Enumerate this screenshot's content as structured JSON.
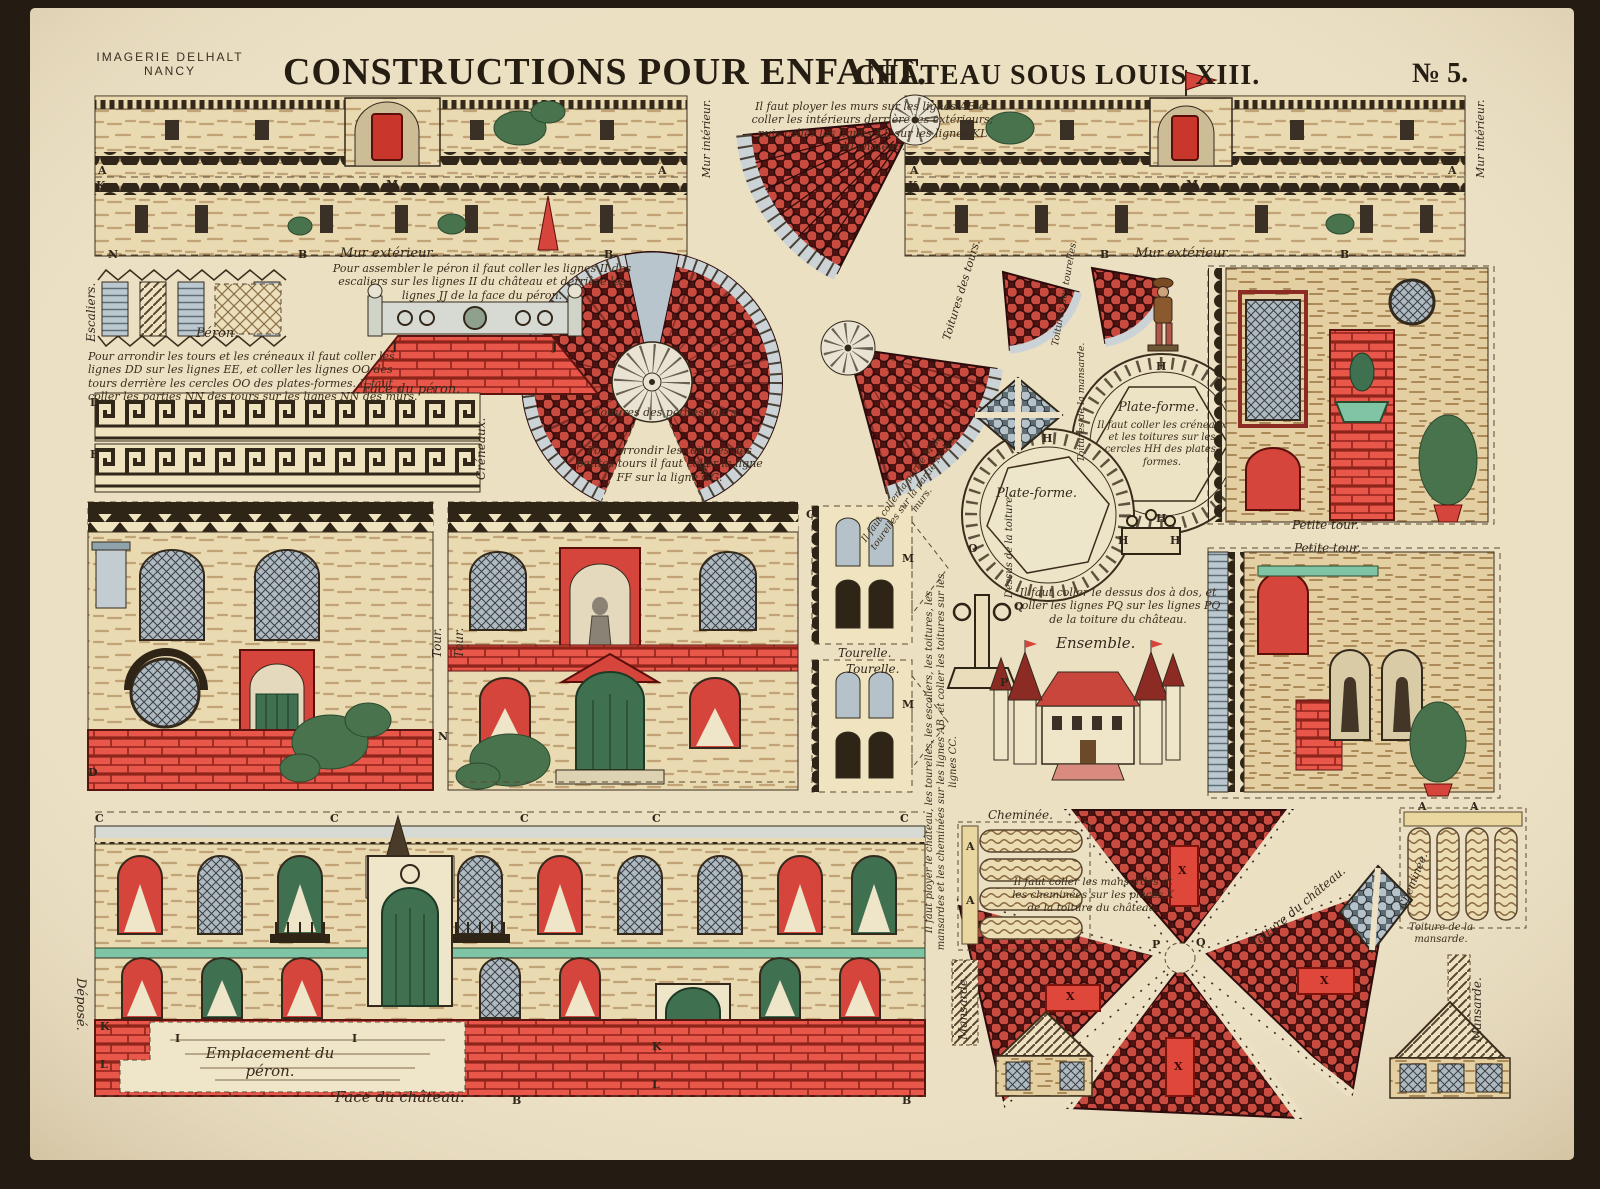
{
  "header": {
    "imprint_line1": "IMAGERIE DELHALT",
    "imprint_line2": "NANCY",
    "title": "CONSTRUCTIONS POUR ENFANT.",
    "subtitle": "CHÂTEAU SOUS LOUIS XIII.",
    "plate_number": "№ 5."
  },
  "labels": {
    "mur_exterieur_left": "Mur extérieur.",
    "mur_exterieur_right": "Mur extérieur.",
    "mur_interieur_left": "Mur intérieur.",
    "mur_interieur_right": "Mur intérieur.",
    "toitures_des_tours": "Toitures des tours.",
    "toitures_des_tourelles": "Toitures des tourelles.",
    "toitures_petites_tours": "Toitures des petites tours.",
    "escaliers": "Escaliers.",
    "peron": "Péron.",
    "face_du_peron": "Face du péron.",
    "creneaux": "Créneaux.",
    "tour_a": "Tour.",
    "tour_b": "Tour.",
    "tourelle_a": "Tourelle.",
    "tourelle_b": "Tourelle.",
    "plate_forme_a": "Plate-forme.",
    "plate_forme_b": "Plate-forme.",
    "dessus_toiture": "Dessus de la toiture.",
    "toitures_mansarde_small": "Toitures de la mansarde.",
    "petite_tour_a": "Petite tour.",
    "petite_tour_b": "Petite tour.",
    "ensemble": "Ensemble.",
    "cheminee_left": "Cheminée.",
    "cheminee_right": "Cheminée.",
    "toiture_du_chateau": "Toiture du château.",
    "toiture_de_la_mansarde": "Toiture de la mansarde.",
    "mansarde_left": "Mansarde.",
    "mansarde_right": "Mansarde.",
    "emplacement_du_peron": "Emplacement du péron.",
    "face_du_chateau": "Face du château.",
    "depose": "Déposé."
  },
  "instructions": {
    "walls": "Il faut ployer les murs sur les lignes AB et coller les intérieurs derrière les extérieurs; puis coller les lignes KL sur les lignes KL du château.",
    "peron": "Pour assembler le péron il faut coller les lignes II des escaliers sur les lignes II du château et derrière les lignes JJ de la face du péron.",
    "tours": "Pour arrondir les tours et les créneaux il faut coller les lignes DD sur les lignes EE, et coller les lignes OO des tours derrière les cercles OO des plates-formes. Il faut coller les parties NN des tours sur les lignes NN des murs.",
    "petites_tours": "Pour arrondir les toitures des petites tours il faut coller la ligne FF sur la ligne GG.",
    "plate_forme": "Il faut coller les créneaux et les toitures sur les cercles HH des plates-formes.",
    "tourelles": "Il faut coller la partie M des tourelles sur la partie M des murs.",
    "dessus": "Il faut coller le dessus dos à dos, et coller les lignes PQ sur les lignes PQ de la toiture du château.",
    "ployer": "Il faut ployer le château, les tourelles, les escaliers, les toitures, les mansardes et les cheminées sur les lignes AB, et coller les toitures sur les lignes CC.",
    "mansardes": "Il faut coller les mansardes et les cheminées sur les places X de la toiture du château."
  },
  "marks": {
    "a": "A",
    "b": "B",
    "c": "C",
    "d": "D",
    "e": "E",
    "f": "F",
    "g": "G",
    "h": "H",
    "i": "I",
    "j": "J",
    "k": "K",
    "l": "L",
    "m": "M",
    "n": "N",
    "o": "O",
    "p": "P",
    "q": "Q",
    "x": "X"
  },
  "colors": {
    "paper": "#ece0c3",
    "ink": "#33291c",
    "brick_red": "#e9564a",
    "roof_dark_red": "#4e1311",
    "roof_scale_red": "#c94b40",
    "blue_grey": "#b6c2c9",
    "foliage_green": "#49734d",
    "teal_green": "#7fc4a4"
  }
}
